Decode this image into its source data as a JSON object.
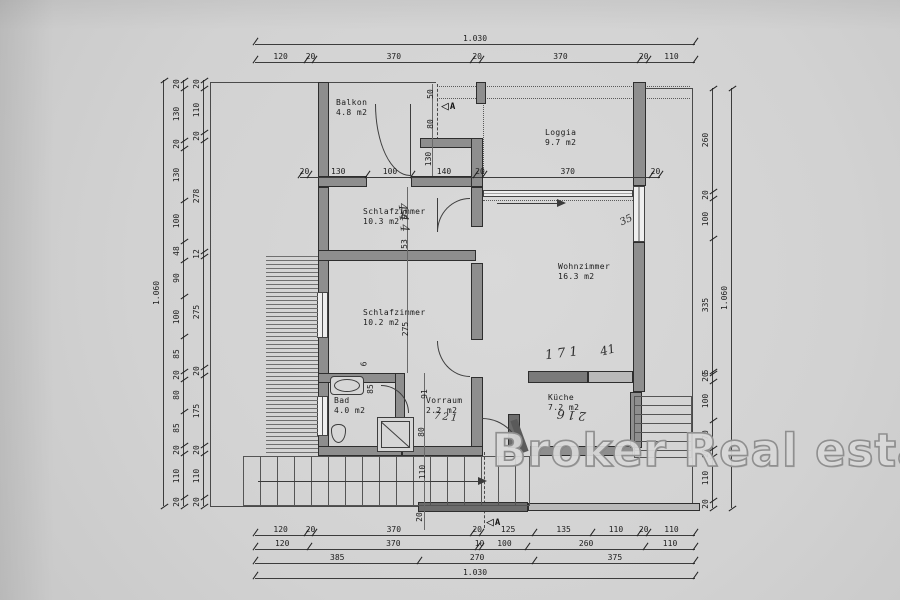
{
  "watermark": "Broker Real estate",
  "section_marker": {
    "label": "A",
    "triangle_icon": "◁"
  },
  "rooms": [
    {
      "id": "balkon",
      "name": "Balkon",
      "area": "4.8 m2"
    },
    {
      "id": "loggia",
      "name": "Loggia",
      "area": "9.7 m2"
    },
    {
      "id": "schlafzimmer1",
      "name": "Schlafzimmer",
      "area": "10.3 m2"
    },
    {
      "id": "schlafzimmer2",
      "name": "Schlafzimmer",
      "area": "10.2 m2"
    },
    {
      "id": "wohnzimmer",
      "name": "Wohnzimmer",
      "area": "16.3 m2"
    },
    {
      "id": "bad",
      "name": "Bad",
      "area": "4.0 m2"
    },
    {
      "id": "vorraum",
      "name": "Vorraum",
      "area": "2.2 m2"
    },
    {
      "id": "kueche",
      "name": "Küche",
      "area": "7.2 m2"
    }
  ],
  "dimension_chains": {
    "top_total": [
      "1.030"
    ],
    "top_segments": [
      "120",
      "20",
      "370",
      "20",
      "370",
      "20",
      "110"
    ],
    "mid_segments": [
      "20",
      "130",
      "100",
      "140",
      "20",
      "370",
      "20"
    ],
    "bottom_row1": [
      "120",
      "20",
      "370",
      "20",
      "125",
      "135",
      "110",
      "20",
      "110"
    ],
    "bottom_row2": [
      "120",
      "370",
      "10",
      "100",
      "260",
      "110"
    ],
    "bottom_row3": [
      "385",
      "270",
      "375"
    ],
    "bottom_total": [
      "1.030"
    ],
    "left_outer": [
      "20",
      "130",
      "20",
      "130",
      "100",
      "48",
      "90",
      "100",
      "85",
      "20",
      "80",
      "85",
      "20",
      "110",
      "20"
    ],
    "left_inner": [
      "20",
      "110",
      "20",
      "278",
      "12",
      "275",
      "20",
      "175",
      "20",
      "110",
      "20"
    ],
    "left_total": [
      "1.060"
    ],
    "right_inner": [
      "260",
      "20",
      "100",
      "335",
      "5",
      "20",
      "100",
      "70",
      "20",
      "110",
      "20"
    ],
    "right_total": [
      "1.060"
    ]
  },
  "interior_dims": {
    "d50": "50",
    "d80": "80",
    "d130": "130",
    "d95": "95",
    "d53": "53",
    "d275": "275",
    "d6": "6",
    "d85": "85",
    "d91": "91",
    "d80b": "80",
    "d110": "110",
    "d20": "20"
  },
  "annotations": {
    "handwriting": [
      "444",
      "171",
      "41",
      "216",
      "35",
      "721"
    ]
  }
}
